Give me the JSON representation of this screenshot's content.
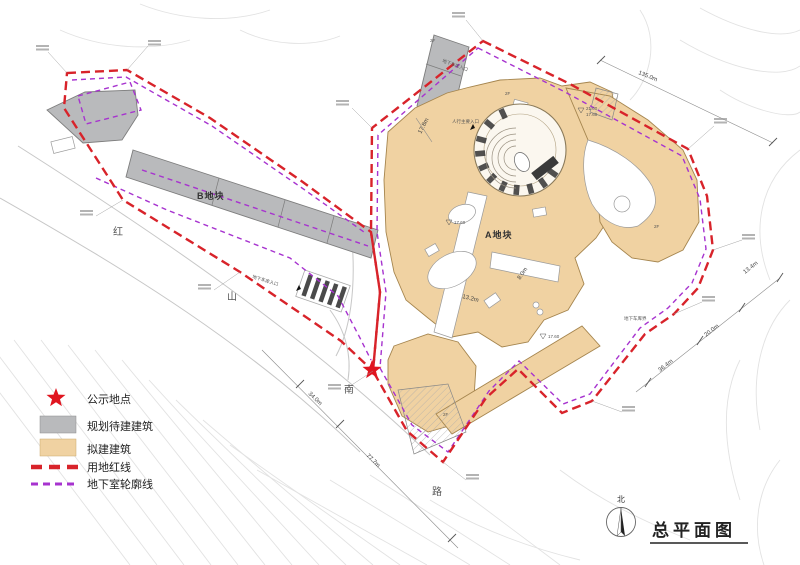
{
  "title": {
    "text": "总平面图"
  },
  "north": {
    "label": "北"
  },
  "legend": {
    "items": [
      {
        "key": "notice-location",
        "label": "公示地点",
        "swatch": "red-star"
      },
      {
        "key": "planned-building",
        "label": "规划待建建筑",
        "swatch": "gray-fill"
      },
      {
        "key": "proposed-building",
        "label": "拟建建筑",
        "swatch": "tan-fill"
      },
      {
        "key": "land-redline",
        "label": "用地红线",
        "swatch": "red-dash"
      },
      {
        "key": "basement-outline",
        "label": "地下室轮廓线",
        "swatch": "purple-dash"
      }
    ]
  },
  "blocks": {
    "a": "A地块",
    "b": "B地块"
  },
  "road": {
    "name": "红山南路",
    "chars": [
      "红",
      "山",
      "南",
      "路"
    ]
  },
  "dimensions": {
    "top_right": "135.0m",
    "right_1": "13.4m",
    "right_2": "20.0m",
    "right_3": "36.4m",
    "bottom_1": "77.7m",
    "bottom_2": "34.0m",
    "entry": "17.8m",
    "small_1": "8.0m",
    "small_2": "13.2m"
  },
  "floors": {
    "f1": "2F",
    "f2": "2F",
    "f3": "2F",
    "f4": "2F"
  },
  "elevations": {
    "e1": "21.00",
    "e2": "17.60",
    "e3": "17.60",
    "e4": "17.60"
  },
  "entrances": {
    "garage": "地下车库入口",
    "garage2": "地下车库入口",
    "pedestrian": "人行主要入口",
    "garage_boundary": "地下车库界"
  },
  "colors": {
    "land_redline": "#d8232a",
    "basement_outline": "#a733cf",
    "planned_building": "#b9babc",
    "proposed_building": "#f0d2a2",
    "notice_star": "#e0151f"
  }
}
